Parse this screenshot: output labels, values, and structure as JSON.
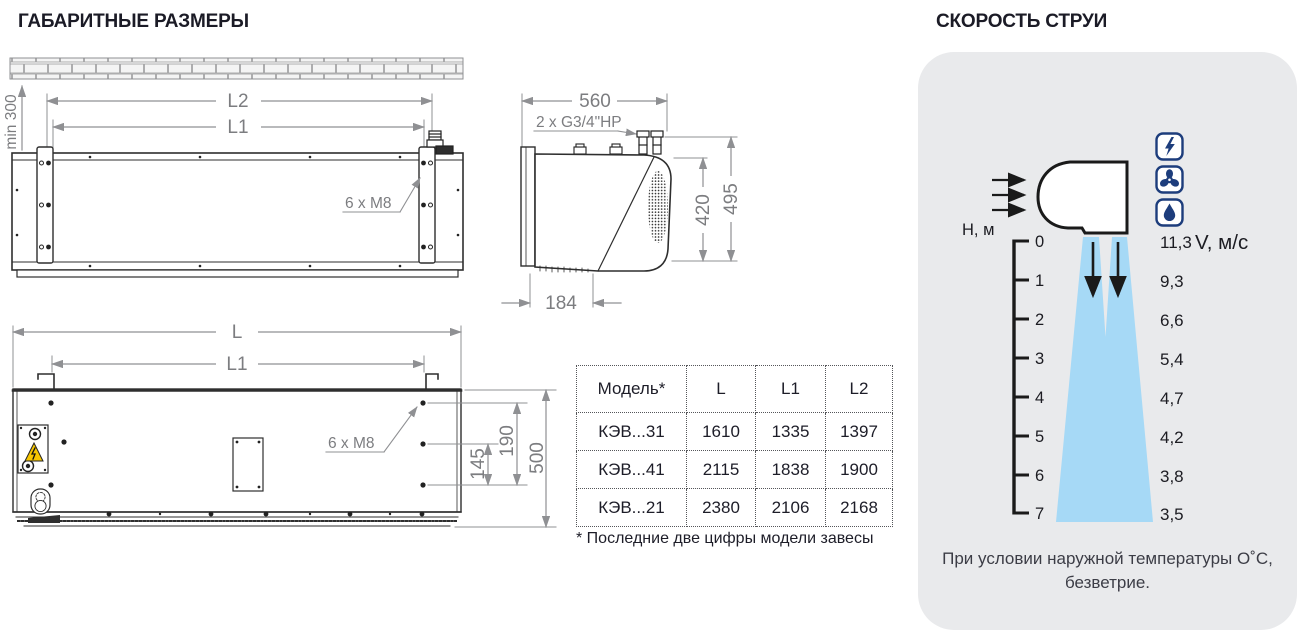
{
  "left": {
    "title": "ГАБАРИТНЫЕ РАЗМЕРЫ",
    "front_view": {
      "min_clearance": "min 300",
      "dim_l2": "L2",
      "dim_l1": "L1",
      "bolt_note": "6 x M8"
    },
    "side_view": {
      "dim_depth": "560",
      "pipe_note": "2 x G3/4\"HP",
      "dim_420": "420",
      "dim_495": "495",
      "dim_184": "184"
    },
    "bottom_view": {
      "dim_l": "L",
      "dim_l1": "L1",
      "bolt_note": "6 x M8",
      "dim_145": "145",
      "dim_190": "190",
      "dim_500": "500"
    },
    "table": {
      "headers": [
        "Модель*",
        "L",
        "L1",
        "L2"
      ],
      "rows": [
        [
          "КЭВ...31",
          "1610",
          "1335",
          "1397"
        ],
        [
          "КЭВ...41",
          "2115",
          "1838",
          "1900"
        ],
        [
          "КЭВ...21",
          "2380",
          "2106",
          "2168"
        ]
      ],
      "footnote": "* Последние две цифры модели завесы"
    }
  },
  "right": {
    "title": "СКОРОСТЬ СТРУИ",
    "axis_label": "H, м",
    "velocity_unit": "V, м/с",
    "ticks": [
      "0",
      "1",
      "2",
      "3",
      "4",
      "5",
      "6",
      "7"
    ],
    "velocities": [
      "11,3",
      "9,3",
      "6,6",
      "5,4",
      "4,7",
      "4,2",
      "3,8",
      "3,5"
    ],
    "icons": [
      "lightning-icon",
      "fan-icon",
      "drop-icon"
    ],
    "note_line1": "При условии наружной температуры О˚С,",
    "note_line2": "безветрие.",
    "colors": {
      "jet_blue": "#a6d9f6",
      "icon_blue": "#1d3d7c",
      "panel_bg": "#e9eaec",
      "warning_yellow": "#f6c500"
    }
  },
  "chart_data": {
    "type": "line",
    "title": "СКОРОСТЬ СТРУИ",
    "xlabel": "H, м",
    "ylabel": "V, м/с",
    "x": [
      0,
      1,
      2,
      3,
      4,
      5,
      6,
      7
    ],
    "values": [
      11.3,
      9.3,
      6.6,
      5.4,
      4.7,
      4.2,
      3.8,
      3.5
    ],
    "note": "При условии наружной температуры О˚С, безветрие.",
    "legend": false,
    "grid": false
  }
}
